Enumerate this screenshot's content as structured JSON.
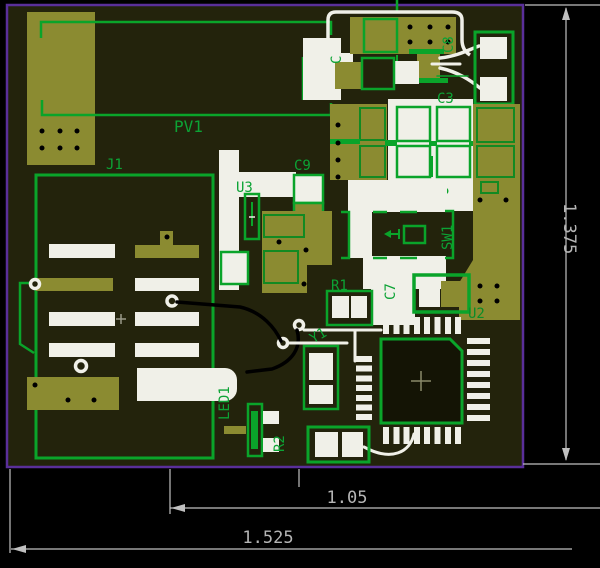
{
  "board": {
    "labels": {
      "pv1": "PV1",
      "j1": "J1",
      "c9": "C9",
      "u3": "U3",
      "c1": "C",
      "c8": "C8",
      "c3": "C3",
      "sw1": "SW1",
      "r1": "R1",
      "c7": "C7",
      "u2": "U2",
      "y1": "Y1",
      "led1": "LED1",
      "r2": "R2"
    }
  },
  "dimensions": {
    "height": "1.375",
    "width_inner": "1.05",
    "width_total": "1.525"
  },
  "colors": {
    "board_background": "#23230c",
    "board_outline_purple": "#5a2f9a",
    "silkscreen_green": "#0aa42a",
    "pad_olive": "#8b8b31",
    "copper_white": "#f0f0e8",
    "inner_outline_green": "#128a22",
    "label_green": "#0ca335",
    "dimension_gray": "#c0c0c0"
  }
}
